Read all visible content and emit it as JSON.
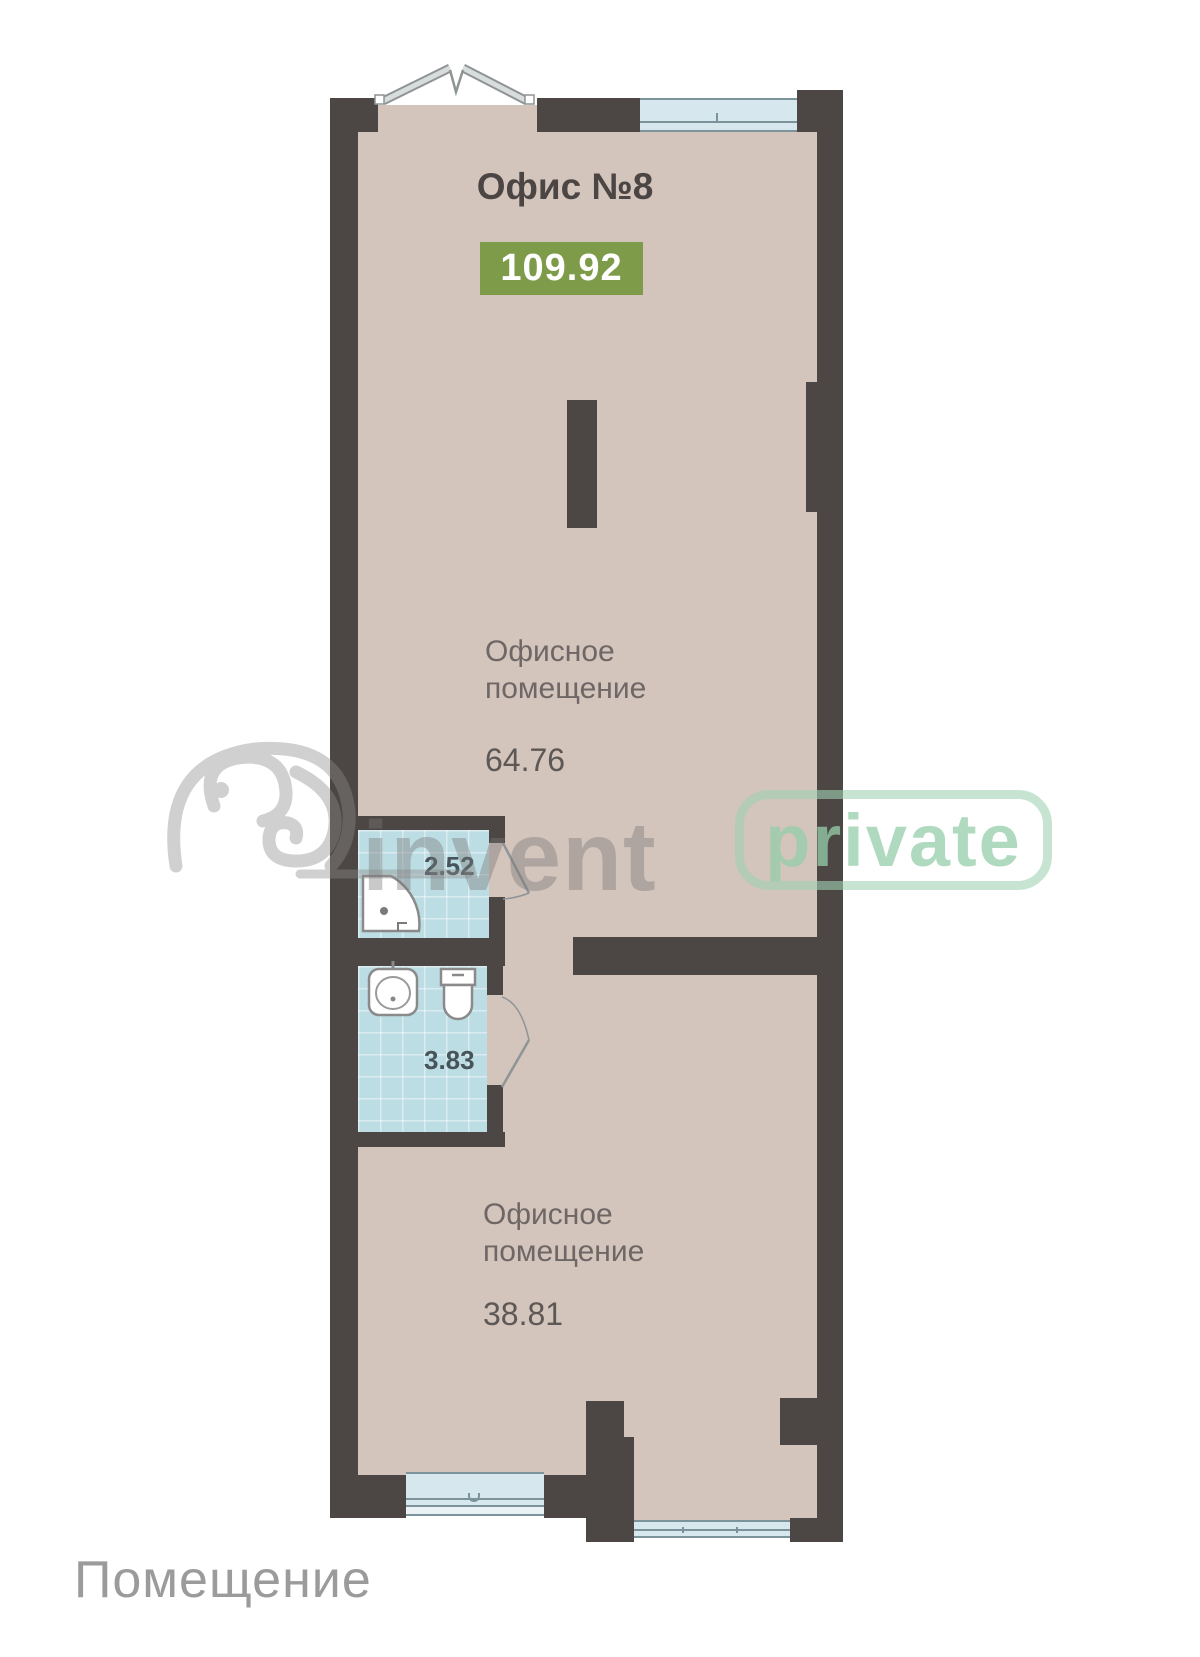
{
  "plan": {
    "title": "Офис №8",
    "total_area": "109.92",
    "rooms": [
      {
        "name": "office-upper",
        "label_line1": "Офисное",
        "label_line2": "помещение",
        "area": "64.76"
      },
      {
        "name": "shower-room",
        "area": "2.52"
      },
      {
        "name": "wc-room",
        "area": "3.83"
      },
      {
        "name": "office-lower",
        "label_line1": "Офисное",
        "label_line2": "помещение",
        "area": "38.81"
      }
    ],
    "colors": {
      "wall": "#4c4744",
      "floor": "#d3c4bc",
      "bathroom_tile": "#bcdde3",
      "window_fill": "#d6e8ed",
      "window_frame": "#7c939b",
      "area_badge_green": "#7d9b48",
      "title_text": "#4b4544",
      "label_text": "#6f6765"
    }
  },
  "watermark": {
    "brand": "invent",
    "badge": "private"
  },
  "footer": {
    "label": "Помещение"
  }
}
